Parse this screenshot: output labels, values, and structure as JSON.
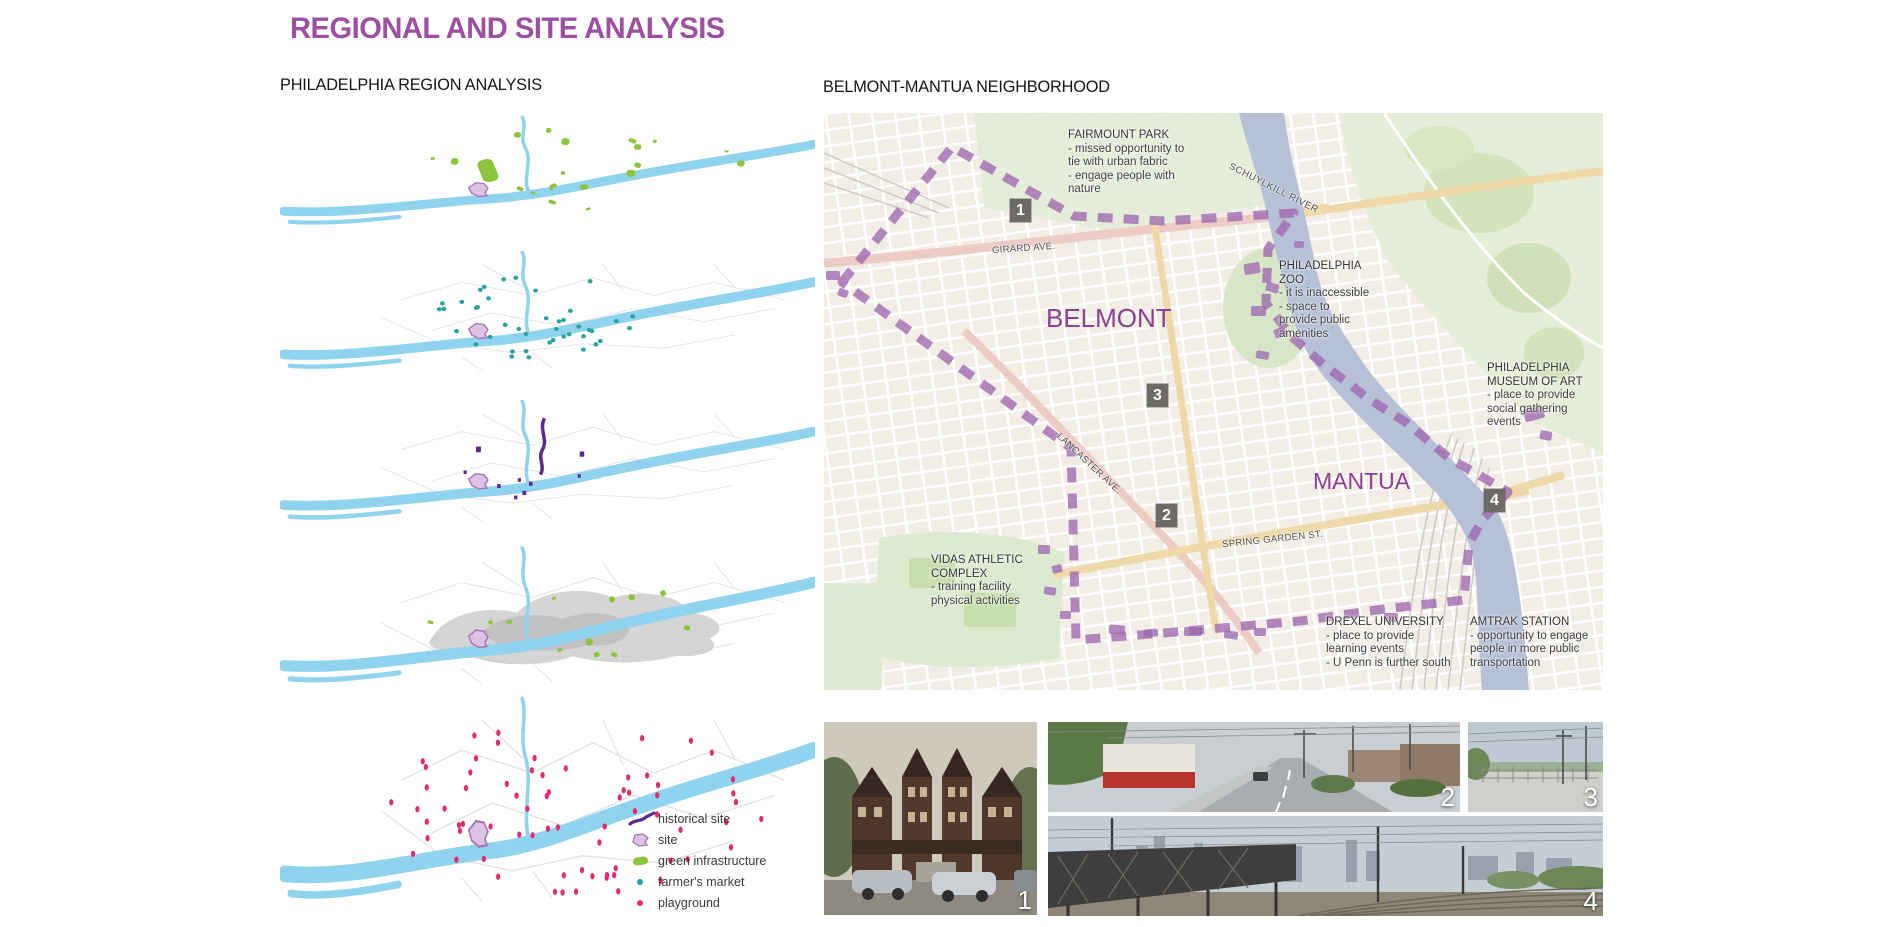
{
  "page": {
    "title": "REGIONAL AND SITE ANALYSIS"
  },
  "left_panel": {
    "heading": "PHILADELPHIA REGION ANALYSIS",
    "legend": [
      {
        "label": "historical site",
        "color": "#5f2a8f"
      },
      {
        "label": "site",
        "color": "#dcc3e6"
      },
      {
        "label": "green infrastructure",
        "color": "#8cc43c"
      },
      {
        "label": "farmer's market",
        "color": "#29a3a0"
      },
      {
        "label": "playground",
        "color": "#e62970"
      }
    ]
  },
  "right_panel": {
    "heading": "BELMONT-MANTUA NEIGHBORHOOD",
    "districts": [
      {
        "name": "BELMONT"
      },
      {
        "name": "MANTUA"
      }
    ],
    "streets": [
      {
        "name": "GIRARD AVE."
      },
      {
        "name": "LANCASTER AVE."
      },
      {
        "name": "SPRING GARDEN ST."
      },
      {
        "name": "SCHUYLKILL RIVER"
      }
    ],
    "markers": [
      {
        "number": "1"
      },
      {
        "number": "2"
      },
      {
        "number": "3"
      },
      {
        "number": "4"
      }
    ],
    "annotations": {
      "fairmount": {
        "title": "FAIRMOUNT PARK",
        "lines": [
          "- missed opportunity to",
          "tie with urban fabric",
          "- engage people with",
          "nature"
        ]
      },
      "zoo": {
        "title": "PHILADELPHIA",
        "title2": "ZOO",
        "lines": [
          "- it is inaccessible",
          "- space to",
          "provide public",
          "amenities"
        ]
      },
      "museum": {
        "title": "PHILADELPHIA",
        "title2": "MUSEUM OF ART",
        "lines": [
          "- place to provide",
          "social gathering",
          "events"
        ]
      },
      "vidas": {
        "title": "VIDAS ATHLETIC",
        "title2": "COMPLEX",
        "lines": [
          "- training facility",
          "physical activities"
        ]
      },
      "drexel": {
        "title": "DREXEL UNIVERSITY",
        "lines": [
          "- place to provide",
          "learning events",
          "- U Penn is further south"
        ]
      },
      "amtrak": {
        "title": "AMTRAK STATION",
        "lines": [
          "- opportunity to engage",
          "people in more public",
          "transportation"
        ]
      }
    },
    "boundary_color": "#9f68b0",
    "marker_color": "#6e6a66",
    "district_color": "#8d3f94"
  },
  "photos": [
    {
      "number": "1"
    },
    {
      "number": "2"
    },
    {
      "number": "3"
    },
    {
      "number": "4"
    }
  ],
  "colors": {
    "accent_purple": "#9d4fa1",
    "river_blue": "#8fd3ef",
    "map_river_gray_blue": "#b6c1d7"
  }
}
